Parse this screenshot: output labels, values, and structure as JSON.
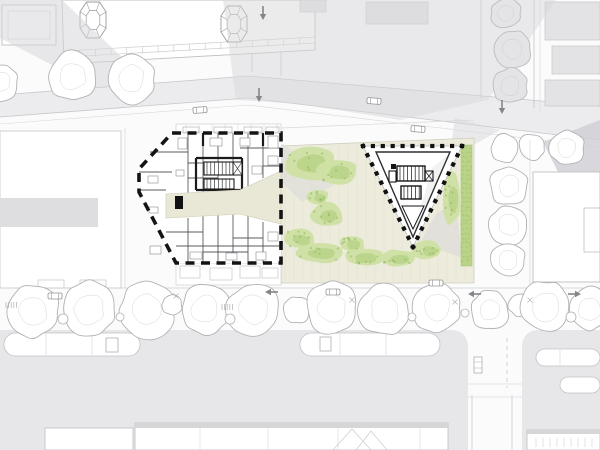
{
  "meta": {
    "description": "Architectural site plan: angular residential building shown as detailed floor plan with heavy dashed boundary, triangular pavilion in a landscaped pocket park, grey context buildings, streets with trees, cars, traffic arrows and tram platforms.",
    "canvas": {
      "width": 600,
      "height": 450
    }
  },
  "palette": {
    "background": "#fbfbfc",
    "white": "#ffffff",
    "street_gray": "#ececee",
    "road_gray": "#e7e7e9",
    "shadow_gray": "#d7d7da",
    "shadow_dark": "#cfcfd3",
    "context_fill": "#e3e3e5",
    "outline_gray": "#bfbfc3",
    "tree_stroke": "#b2b2b6",
    "wall_thin": "#4a4a4f",
    "wall_thick": "#1b1b1b",
    "black": "#141414",
    "beige": "#edecdc",
    "beige_line": "#d8d5c0",
    "green_light": "#cfe0a4",
    "green_mid": "#b9d488",
    "green_dark": "#8fb95e",
    "furniture": "#9a9aa0"
  },
  "shadows": [
    {
      "layer": "context",
      "points": [
        [
          0,
          0
        ],
        [
          62,
          0
        ],
        [
          146,
          80
        ],
        [
          96,
          88
        ],
        [
          0,
          38
        ]
      ],
      "opacity": 0.55,
      "dark": false
    },
    {
      "layer": "context",
      "points": [
        [
          223,
          0
        ],
        [
          556,
          0
        ],
        [
          488,
          100
        ],
        [
          400,
          120
        ],
        [
          300,
          104
        ],
        [
          236,
          100
        ],
        [
          228,
          40
        ]
      ],
      "opacity": 0.5,
      "dark": false
    },
    {
      "layer": "context",
      "points": [
        [
          543,
          142
        ],
        [
          600,
          120
        ],
        [
          600,
          174
        ],
        [
          558,
          172
        ]
      ],
      "opacity": 0.8,
      "dark": true
    },
    {
      "layer": "context",
      "points": [
        [
          455,
          118
        ],
        [
          500,
          130
        ],
        [
          472,
          146
        ],
        [
          452,
          140
        ]
      ],
      "opacity": 0.5,
      "dark": false
    },
    {
      "layer": "site",
      "points": [
        [
          281,
          143
        ],
        [
          340,
          182
        ],
        [
          302,
          202
        ],
        [
          281,
          182
        ]
      ],
      "opacity": 0.5,
      "dark": false
    },
    {
      "layer": "site",
      "points": [
        [
          420,
          242
        ],
        [
          462,
          258
        ],
        [
          456,
          202
        ],
        [
          436,
          214
        ]
      ],
      "opacity": 0.55,
      "dark": false
    }
  ],
  "trees": {
    "bottom_row": [
      [
        33,
        311,
        26
      ],
      [
        89,
        309,
        27
      ],
      [
        148,
        310,
        27
      ],
      [
        172,
        305,
        10
      ],
      [
        205,
        309,
        24
      ],
      [
        254,
        310,
        26
      ],
      [
        297,
        310,
        13
      ],
      [
        332,
        308,
        25
      ],
      [
        385,
        310,
        25
      ],
      [
        437,
        308,
        24
      ],
      [
        490,
        310,
        19
      ],
      [
        520,
        305,
        11
      ],
      [
        546,
        307,
        25
      ],
      [
        590,
        309,
        21
      ]
    ],
    "top_row": [
      [
        0,
        82,
        18
      ],
      [
        73,
        76,
        24
      ],
      [
        131,
        79,
        24
      ]
    ],
    "east_column": [
      [
        505,
        148,
        14
      ],
      [
        509,
        186,
        19
      ],
      [
        509,
        225,
        19
      ],
      [
        508,
        260,
        17
      ],
      [
        532,
        147,
        13
      ],
      [
        567,
        148,
        17
      ]
    ],
    "right_street_gray": [
      [
        506,
        13,
        15
      ],
      [
        513,
        49,
        18
      ],
      [
        510,
        86,
        17
      ]
    ],
    "shrubs": [
      [
        63,
        319,
        5
      ],
      [
        120,
        317,
        4
      ],
      [
        230,
        319,
        5
      ],
      [
        412,
        317,
        4
      ],
      [
        465,
        313,
        4
      ],
      [
        571,
        317,
        5
      ]
    ]
  },
  "park": {
    "ground": [
      [
        281,
        146
      ],
      [
        474,
        138
      ],
      [
        474,
        283
      ],
      [
        281,
        283
      ]
    ],
    "paving": {
      "x1": 285,
      "x2": 471,
      "step": 9,
      "y_top_left": 149,
      "y_top_right": 141,
      "y_bottom": 281
    },
    "blobs": [
      [
        310,
        163,
        27,
        17
      ],
      [
        338,
        172,
        20,
        13
      ],
      [
        318,
        197,
        11,
        8
      ],
      [
        327,
        215,
        17,
        12
      ],
      [
        300,
        239,
        16,
        10
      ],
      [
        320,
        253,
        26,
        10
      ],
      [
        352,
        244,
        13,
        8
      ],
      [
        364,
        257,
        21,
        9
      ],
      [
        398,
        258,
        19,
        8
      ],
      [
        428,
        250,
        15,
        9
      ],
      [
        452,
        198,
        9,
        26
      ]
    ],
    "hedge": {
      "x": 461,
      "y": 145,
      "w": 11,
      "h": 121
    }
  },
  "triangle_building": {
    "outer": [
      [
        363,
        146
      ],
      [
        462,
        146
      ],
      [
        413,
        247
      ]
    ],
    "inner": [
      [
        376,
        152
      ],
      [
        450,
        152
      ],
      [
        413,
        237
      ]
    ],
    "dot_size": 4.2,
    "dot_spacing": 9.5
  },
  "floor_plan": {
    "outline": [
      [
        172,
        133
      ],
      [
        281,
        133
      ],
      [
        281,
        263
      ],
      [
        176,
        263
      ],
      [
        139,
        192
      ],
      [
        139,
        169
      ]
    ],
    "corridor": [
      [
        166,
        194
      ],
      [
        240,
        190
      ],
      [
        281,
        171
      ],
      [
        281,
        224
      ],
      [
        240,
        214
      ],
      [
        166,
        218
      ]
    ],
    "entrance_block": [
      175,
      196,
      8,
      13
    ],
    "walls_thin": [
      [
        188,
        133,
        188,
        194
      ],
      [
        203,
        133,
        203,
        192
      ],
      [
        218,
        133,
        218,
        190
      ],
      [
        233,
        133,
        233,
        163
      ],
      [
        248,
        133,
        248,
        186
      ],
      [
        263,
        133,
        263,
        178
      ],
      [
        188,
        218,
        188,
        263
      ],
      [
        203,
        216,
        203,
        263
      ],
      [
        218,
        214,
        218,
        263
      ],
      [
        233,
        214,
        233,
        263
      ],
      [
        248,
        212,
        248,
        263
      ],
      [
        263,
        222,
        263,
        263
      ],
      [
        139,
        172,
        172,
        172
      ],
      [
        139,
        190,
        166,
        190
      ],
      [
        150,
        152,
        188,
        152
      ],
      [
        188,
        163,
        233,
        163
      ],
      [
        240,
        148,
        281,
        148
      ],
      [
        263,
        166,
        281,
        166
      ],
      [
        188,
        178,
        218,
        178
      ],
      [
        176,
        246,
        281,
        246
      ],
      [
        203,
        252,
        248,
        252
      ],
      [
        166,
        232,
        203,
        232
      ],
      [
        233,
        238,
        263,
        238
      ]
    ],
    "walls_thick": [
      [
        196,
        158,
        242,
        158
      ],
      [
        196,
        158,
        196,
        190
      ],
      [
        242,
        158,
        242,
        190
      ],
      [
        196,
        190,
        242,
        190
      ],
      [
        203,
        133,
        203,
        146
      ],
      [
        263,
        133,
        263,
        146
      ]
    ],
    "stairs": [
      {
        "rect": [
          204,
          162,
          30,
          13
        ],
        "step": 3.8
      },
      {
        "rect": [
          204,
          179,
          30,
          10
        ],
        "step": 3.8
      }
    ],
    "lift": [
      233,
      162,
      9,
      13
    ],
    "furniture": [
      [
        148,
        176,
        10,
        7
      ],
      [
        149,
        207,
        9,
        6
      ],
      [
        178,
        138,
        9,
        11
      ],
      [
        210,
        138,
        12,
        8
      ],
      [
        240,
        138,
        10,
        8
      ],
      [
        268,
        136,
        10,
        12
      ],
      [
        252,
        166,
        10,
        8
      ],
      [
        268,
        156,
        10,
        9
      ],
      [
        150,
        246,
        11,
        8
      ],
      [
        190,
        252,
        12,
        7
      ],
      [
        226,
        253,
        11,
        7
      ],
      [
        256,
        252,
        10,
        8
      ],
      [
        268,
        232,
        10,
        9
      ],
      [
        176,
        170,
        8,
        6
      ]
    ],
    "balconies": [
      [
        183,
        127,
        16,
        6
      ],
      [
        214,
        127,
        18,
        6
      ],
      [
        244,
        127,
        18,
        6
      ],
      [
        266,
        127,
        13,
        6
      ]
    ],
    "lower_annex": [
      [
        180,
        266,
        20,
        12
      ],
      [
        210,
        268,
        22,
        12
      ],
      [
        240,
        266,
        20,
        12
      ],
      [
        262,
        268,
        16,
        10
      ]
    ],
    "upper_strip": {
      "x": 176,
      "y": 124,
      "w": 105,
      "h": 8,
      "tick_step": 13
    }
  },
  "bay_towers": [
    [
      93,
      20
    ],
    [
      234,
      24
    ]
  ],
  "facade": {
    "from": [
      64,
      51
    ],
    "to": [
      315,
      37
    ],
    "ticks": 16,
    "len": 7
  },
  "traffic": {
    "arrows": [
      {
        "x": 263,
        "y": 6,
        "dir": "down"
      },
      {
        "x": 259,
        "y": 88,
        "dir": "down"
      },
      {
        "x": 502,
        "y": 100,
        "dir": "down"
      },
      {
        "x": 268,
        "y": 292,
        "dir": "left"
      },
      {
        "x": 471,
        "y": 294,
        "dir": "left"
      },
      {
        "x": 578,
        "y": 294,
        "dir": "right"
      }
    ],
    "cars": [
      {
        "x": 200,
        "y": 110,
        "rot": -4
      },
      {
        "x": 374,
        "y": 101,
        "rot": 4
      },
      {
        "x": 418,
        "y": 129,
        "rot": 4
      },
      {
        "x": 55,
        "y": 296,
        "rot": 0
      },
      {
        "x": 333,
        "y": 292,
        "rot": 0
      },
      {
        "x": 436,
        "y": 283,
        "rot": 0
      }
    ]
  },
  "platforms": [
    {
      "x": 4,
      "y": 333,
      "w": 136,
      "h": 23,
      "lines": [
        46,
        92
      ],
      "box": [
        106,
        338,
        12,
        14
      ]
    },
    {
      "x": 300,
      "y": 333,
      "w": 140,
      "h": 23,
      "lines": [
        340,
        386
      ],
      "box": [
        320,
        337,
        11,
        14
      ]
    },
    {
      "x": 536,
      "y": 349,
      "w": 64,
      "h": 17,
      "lines": [
        560
      ],
      "box": null
    },
    {
      "x": 560,
      "y": 377,
      "w": 40,
      "h": 16,
      "lines": [],
      "box": null
    }
  ],
  "ground_marks": {
    "x_marks": [
      [
        176,
        296
      ],
      [
        352,
        300
      ],
      [
        455,
        302
      ],
      [
        530,
        300
      ]
    ],
    "racks": [
      [
        6,
        302
      ],
      [
        222,
        304
      ]
    ]
  },
  "south_buildings": {
    "right_ticks": {
      "x1": 536,
      "x2": 594,
      "step": 7,
      "y1": 438,
      "y2": 447
    }
  }
}
